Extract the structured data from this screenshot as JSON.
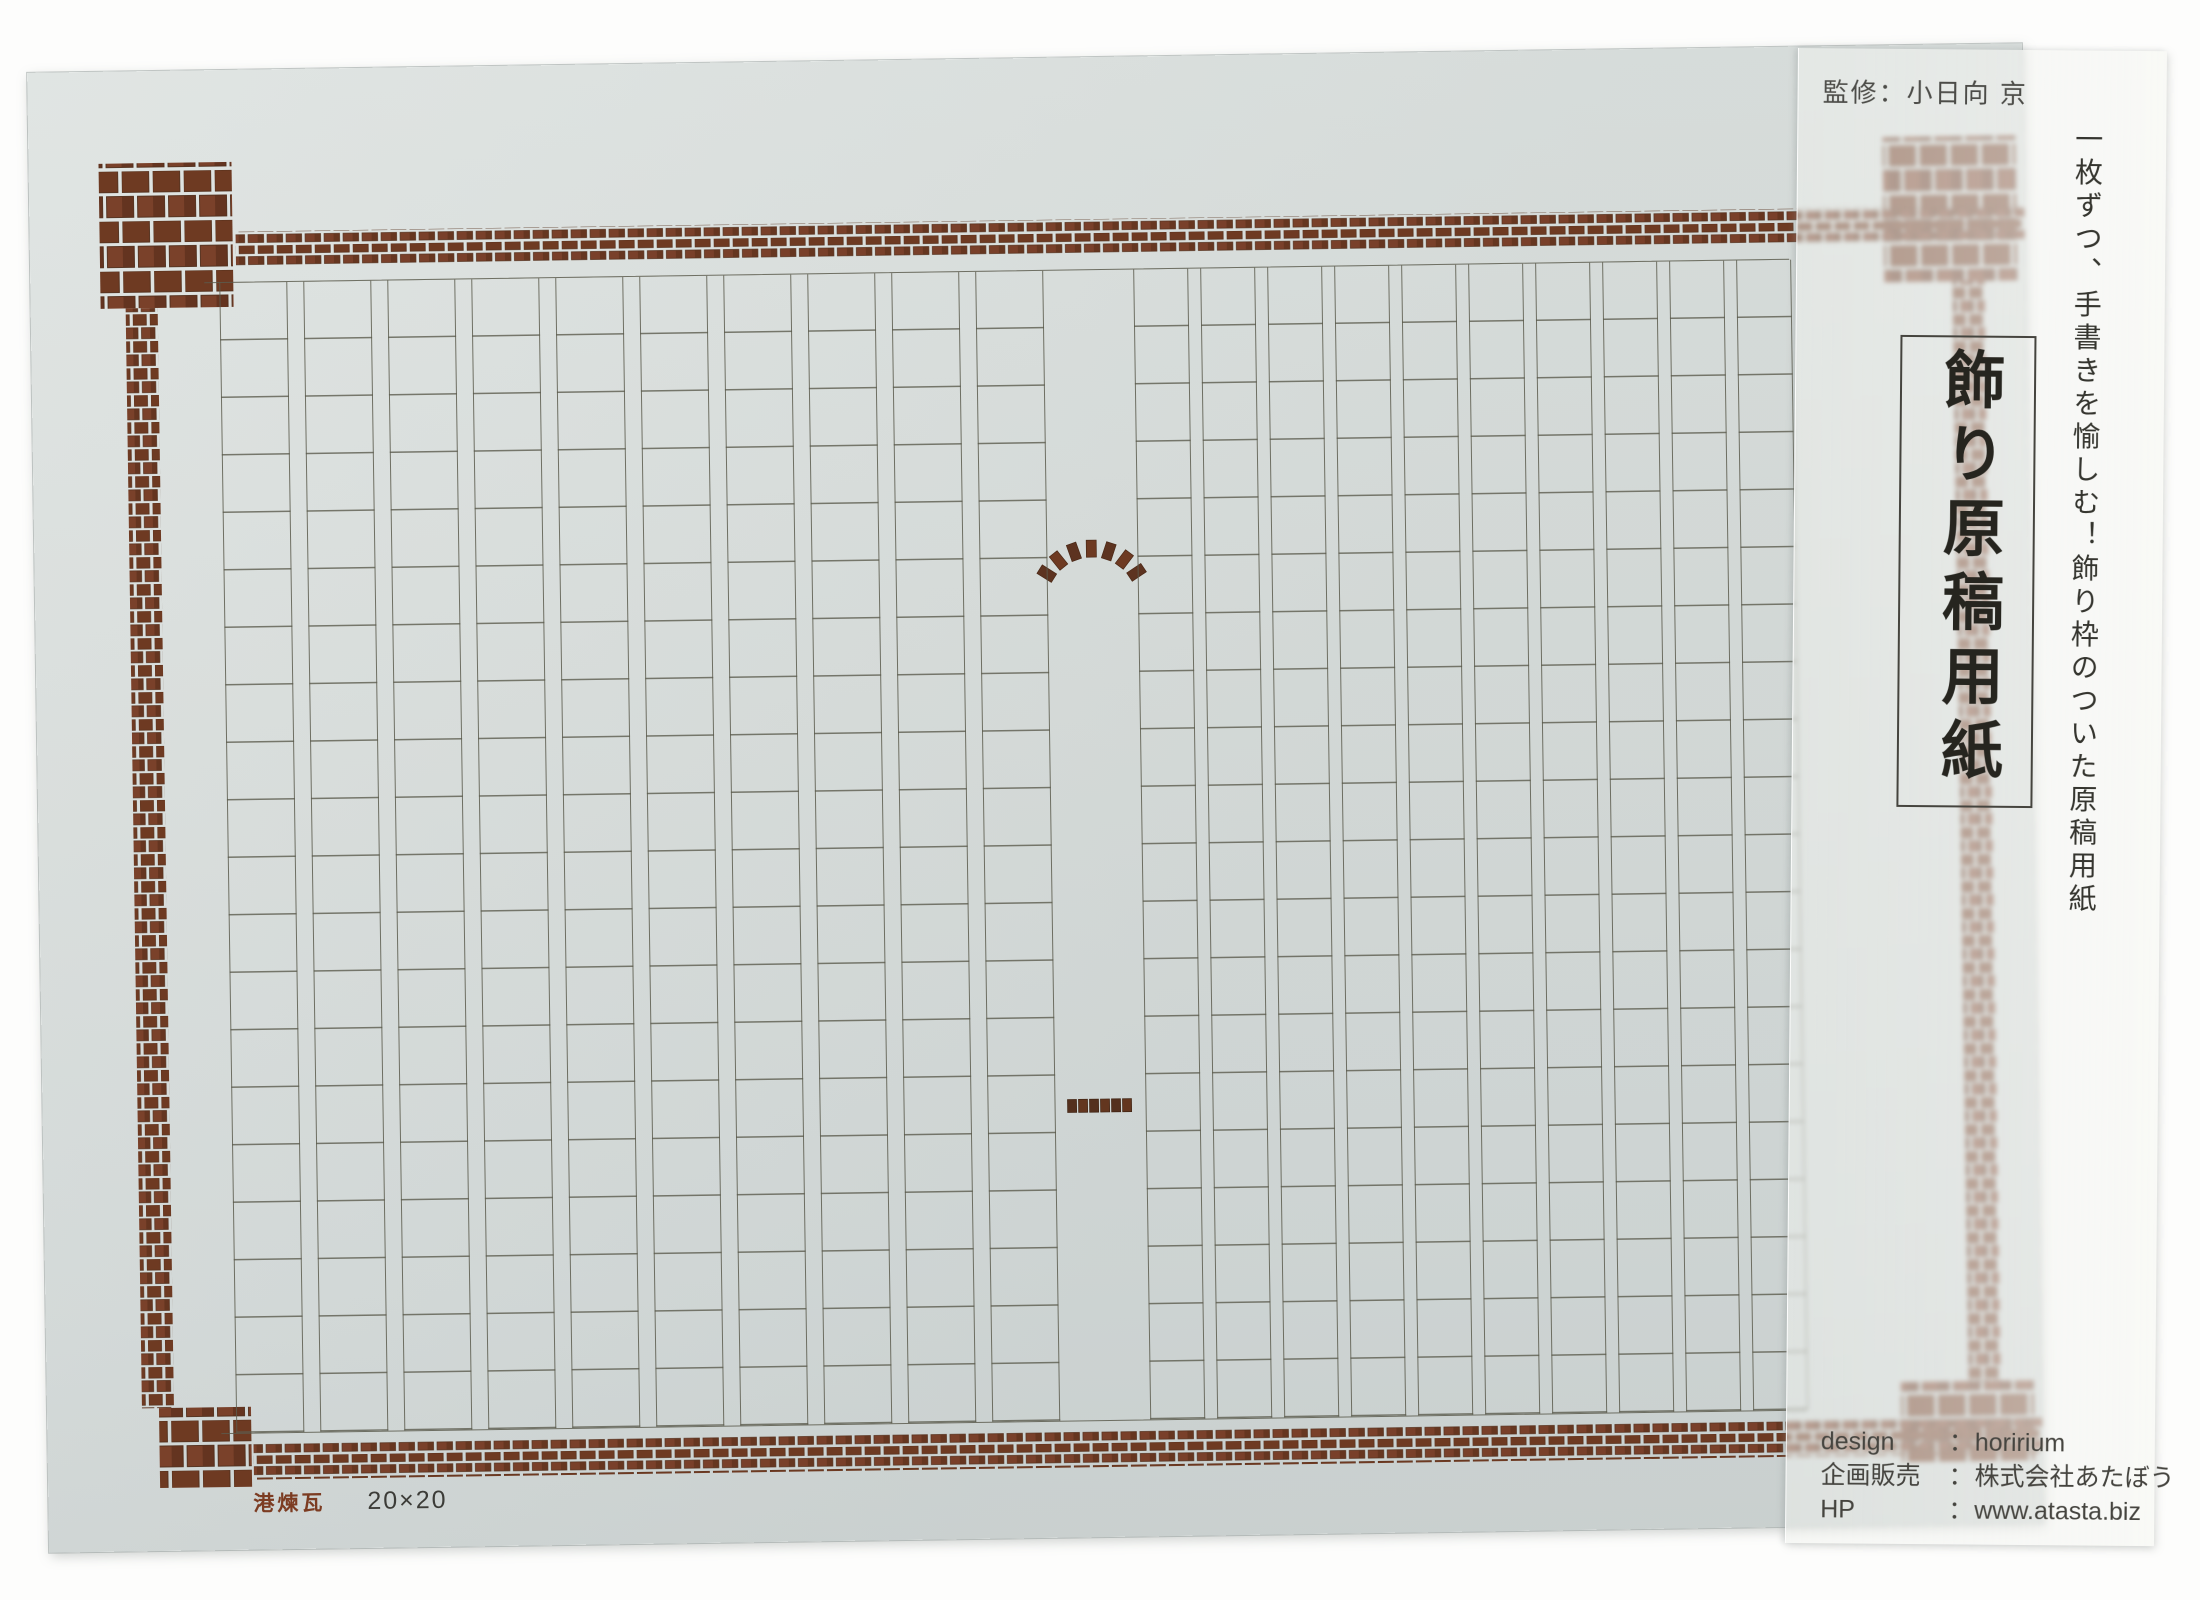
{
  "photo": {
    "supervisor_note": "監修：小日向 京",
    "tagline": "一枚ずつ、手書きを愉しむ！飾り枠のついた原稿用紙",
    "product_title": "飾り原稿用紙",
    "pattern_caption": "港煉瓦",
    "grid_caption": "20×20",
    "info": [
      {
        "label": "design",
        "sep": "：",
        "value": "horirium"
      },
      {
        "label": "企画販売",
        "sep": "：",
        "value": "株式会社あたぼう"
      },
      {
        "label": "HP",
        "sep": "：",
        "value": "www.atasta.biz"
      }
    ],
    "grid": {
      "rows": 20,
      "columns": 20,
      "label": "20×20"
    },
    "colors": {
      "brick": "#6e3a22",
      "paper": "#d8dddb",
      "grid_line": "#5c5c4e",
      "caption_red": "#7c3c22"
    }
  }
}
